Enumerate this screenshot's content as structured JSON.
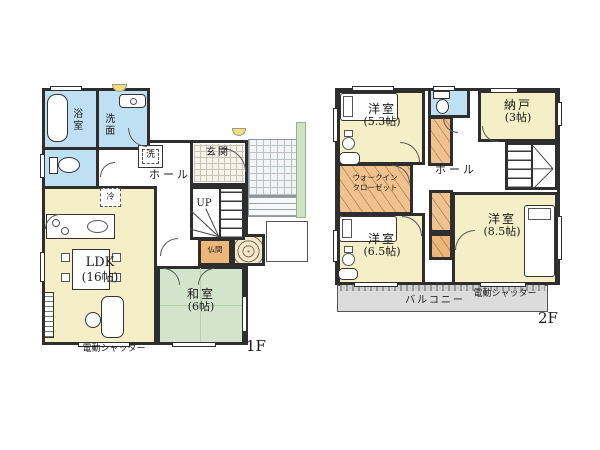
{
  "colors": {
    "wall": "#2e2e2e",
    "room_cream": "#f4efc6",
    "tatami_green": "#d2e4cb",
    "water_blue": "#bfe0f2",
    "closet_orange": "#f0c28f",
    "butsuma_orange": "#edb77c",
    "balcony_gray": "#dcdcdc",
    "approach_green": "#cfe2c4"
  },
  "floor1": {
    "floor_label": "1F",
    "shutter_label": "電動シャッター",
    "rooms": {
      "bathroom": "浴室",
      "washroom": "洗面",
      "laundry": "洗",
      "hall": "ホール",
      "entrance": "玄関",
      "stairs_up": "UP",
      "fridge": "冷",
      "ldk_name": "LDK",
      "ldk_size": "(16帖)",
      "butsuma": "仏間",
      "washitsu_name": "和室",
      "washitsu_size": "(6帖)"
    }
  },
  "floor2": {
    "floor_label": "2F",
    "shutter_label": "電動シャッター",
    "balcony_label": "バルコニー",
    "rooms": {
      "bedroom1_name": "洋室",
      "bedroom1_size": "(5.3帖)",
      "storage_name": "納戸",
      "storage_size": "(3帖)",
      "hall": "ホール",
      "wic_line1": "ウォークイン",
      "wic_line2": "クローゼット",
      "bedroom2_name": "洋室",
      "bedroom2_size": "(6.5帖)",
      "bedroom3_name": "洋室",
      "bedroom3_size": "(8.5帖)"
    }
  }
}
